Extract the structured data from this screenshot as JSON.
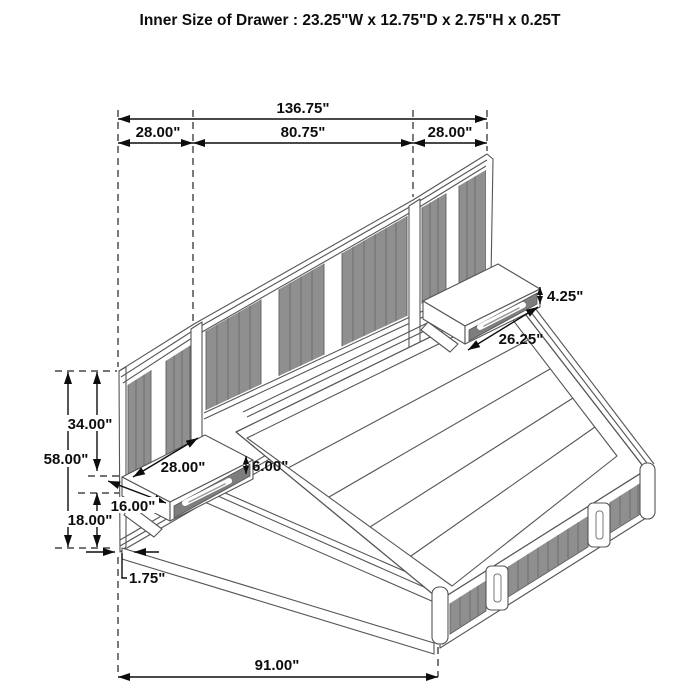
{
  "title": "Inner Size of Drawer : 23.25\"W x 12.75\"D x 2.75\"H x 0.25T",
  "dims": {
    "overall_width": "136.75\"",
    "left_panel_width": "28.00\"",
    "center_panel_width": "80.75\"",
    "right_panel_width": "28.00\"",
    "right_shelf_height": "4.25\"",
    "right_shelf_width": "26.25\"",
    "headboard_top_to_shelf": "34.00\"",
    "headboard_height": "58.00\"",
    "left_shelf_width": "28.00\"",
    "left_shelf_height": "6.00\"",
    "left_shelf_depth": "16.00\"",
    "shelf_bottom_to_floor": "18.00\"",
    "panel_thickness": "1.75\"",
    "bed_length": "91.00\""
  },
  "colors": {
    "background": "#ffffff",
    "line_work": "#555555",
    "dimension_lines": "#0d0d0d",
    "panel_stripe": "#8f8f8f",
    "stripe_plank_line": "#6d6d6d",
    "drawer_face": "#7d7d7d"
  }
}
